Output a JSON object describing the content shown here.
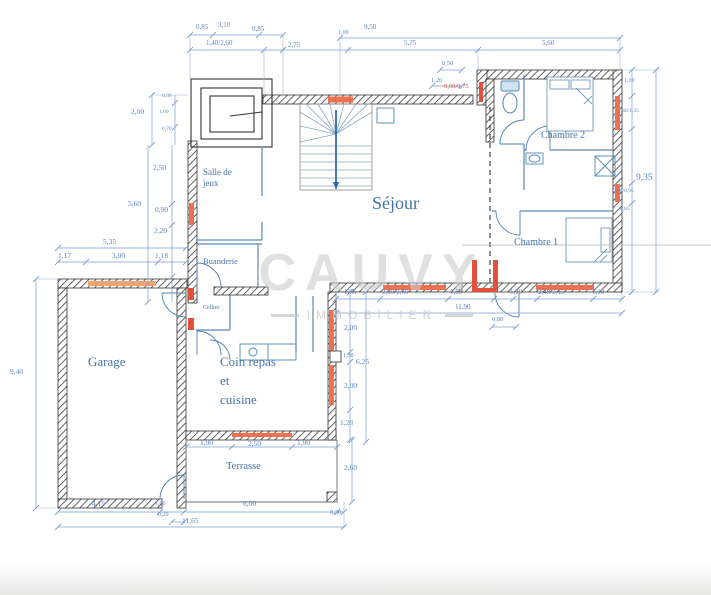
{
  "watermark": {
    "brand": "CAUVY",
    "subtitle": "IMMOBILIER"
  },
  "rooms": {
    "sejour": "Séjour",
    "garage": "Garage",
    "chambre1": "Chambre 1",
    "chambre2": "Chambre 2",
    "salle_jeux_l1": "Salle de",
    "salle_jeux_l2": "jeux",
    "buanderie": "Buanderie",
    "cellier": "Cellier",
    "coin_l1": "Coin repas",
    "coin_l2": "et",
    "coin_l3": "cuisine",
    "terrasse": "Terrasse"
  },
  "dims": {
    "t1": "0,85",
    "t2": "3,10",
    "t3": "0,85",
    "t4": "1,40/2,60",
    "t5": "2,75",
    "t6": "1,00",
    "t7": "9,50",
    "t8": "5,75",
    "t9": "5,60",
    "t10": "0,50",
    "t11": "1,20",
    "t12": "0,60/0,75",
    "r1": "1,10",
    "r2": "1,40/1,35",
    "r3": "9,35",
    "r4": "0,80/0,95",
    "r5": "6,85",
    "m1": "1,65",
    "m2": "2,80/2,60",
    "m3": "1,85",
    "m4": "11,90",
    "m5": "0,80",
    "m6": "1,10",
    "m7": "2,40/2,15",
    "m8": "1,10",
    "l1": "2,00",
    "l2": "0,30",
    "l3": "1,00",
    "l4": "0,70",
    "l5": "2,50",
    "l6": "5,60",
    "l7": "0,90",
    "l8": "2,20",
    "l9": "5,35",
    "l10": "1,17",
    "l11": "3,00",
    "l12": "1,18",
    "l13": "9,40",
    "k1": "2,00",
    "k2": "1,30",
    "k3": "6,25",
    "k4": "2,00",
    "k5": "1,28",
    "k6": "2,60",
    "b1": "1,90",
    "b2": "2,50",
    "b3": "1,90",
    "b4": "6,00",
    "b5": "0,30",
    "b6": "11,65",
    "b7": "4,15",
    "b8": "1,00",
    "b9": "0,20"
  },
  "colors": {
    "window_accent": "#ef7050",
    "dimension_blue": "#5b84c0",
    "label_blue": "#4673a9",
    "watermark_gray": "#cdcdcd"
  }
}
